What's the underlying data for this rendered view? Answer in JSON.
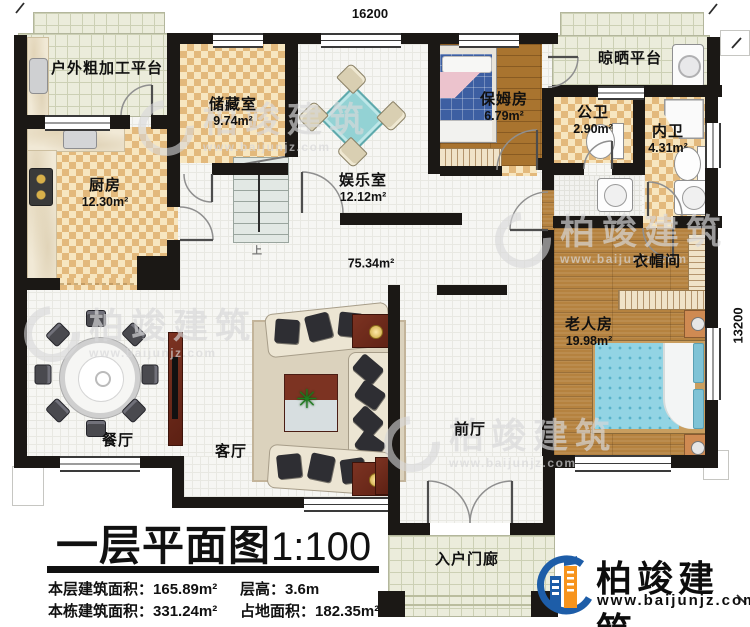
{
  "dimensions": {
    "top": "16200",
    "right": "13200"
  },
  "title": {
    "text": "一层平面图",
    "scale": "1:100"
  },
  "stats": [
    {
      "label": "本层建筑面积：",
      "value": "165.89m²"
    },
    {
      "label": "层高：",
      "value": "3.6m"
    },
    {
      "label": "本栋建筑面积：",
      "value": "331.24m²"
    },
    {
      "label": "占地面积：",
      "value": "182.35m²"
    }
  ],
  "rooms": [
    {
      "name": "户外粗加工平台",
      "area": ""
    },
    {
      "name": "储藏室",
      "area": "9.74m²"
    },
    {
      "name": "娱乐室",
      "area": "12.12m²"
    },
    {
      "name": "厨房",
      "area": "12.30m²"
    },
    {
      "name": "保姆房",
      "area": "6.79m²"
    },
    {
      "name": "晾晒平台",
      "area": ""
    },
    {
      "name": "公卫",
      "area": "2.90m²"
    },
    {
      "name": "内卫",
      "area": "4.31m²"
    },
    {
      "name": "衣帽间",
      "area": ""
    },
    {
      "name": "老人房",
      "area": "19.98m²"
    },
    {
      "name": "餐厅",
      "area": ""
    },
    {
      "name": "客厅",
      "area": ""
    },
    {
      "name": "前厅",
      "area": ""
    },
    {
      "name": "入户门廊",
      "area": ""
    },
    {
      "name": "",
      "area": "75.34m²"
    }
  ],
  "stairs": {
    "up_label": "上"
  },
  "icons": {
    "plant": "✳"
  },
  "watermark": {
    "name": "柏竣建筑",
    "site": "www.baijunjz.com"
  },
  "brand": {
    "name": "柏竣建筑",
    "site": "www.baijunjz.com"
  },
  "colors": {
    "wall": "#1b1815",
    "accent_blue": "#1d5da8",
    "accent_orange": "#f7941d",
    "checker": "#e3b97c",
    "wood": "#b5823f"
  }
}
